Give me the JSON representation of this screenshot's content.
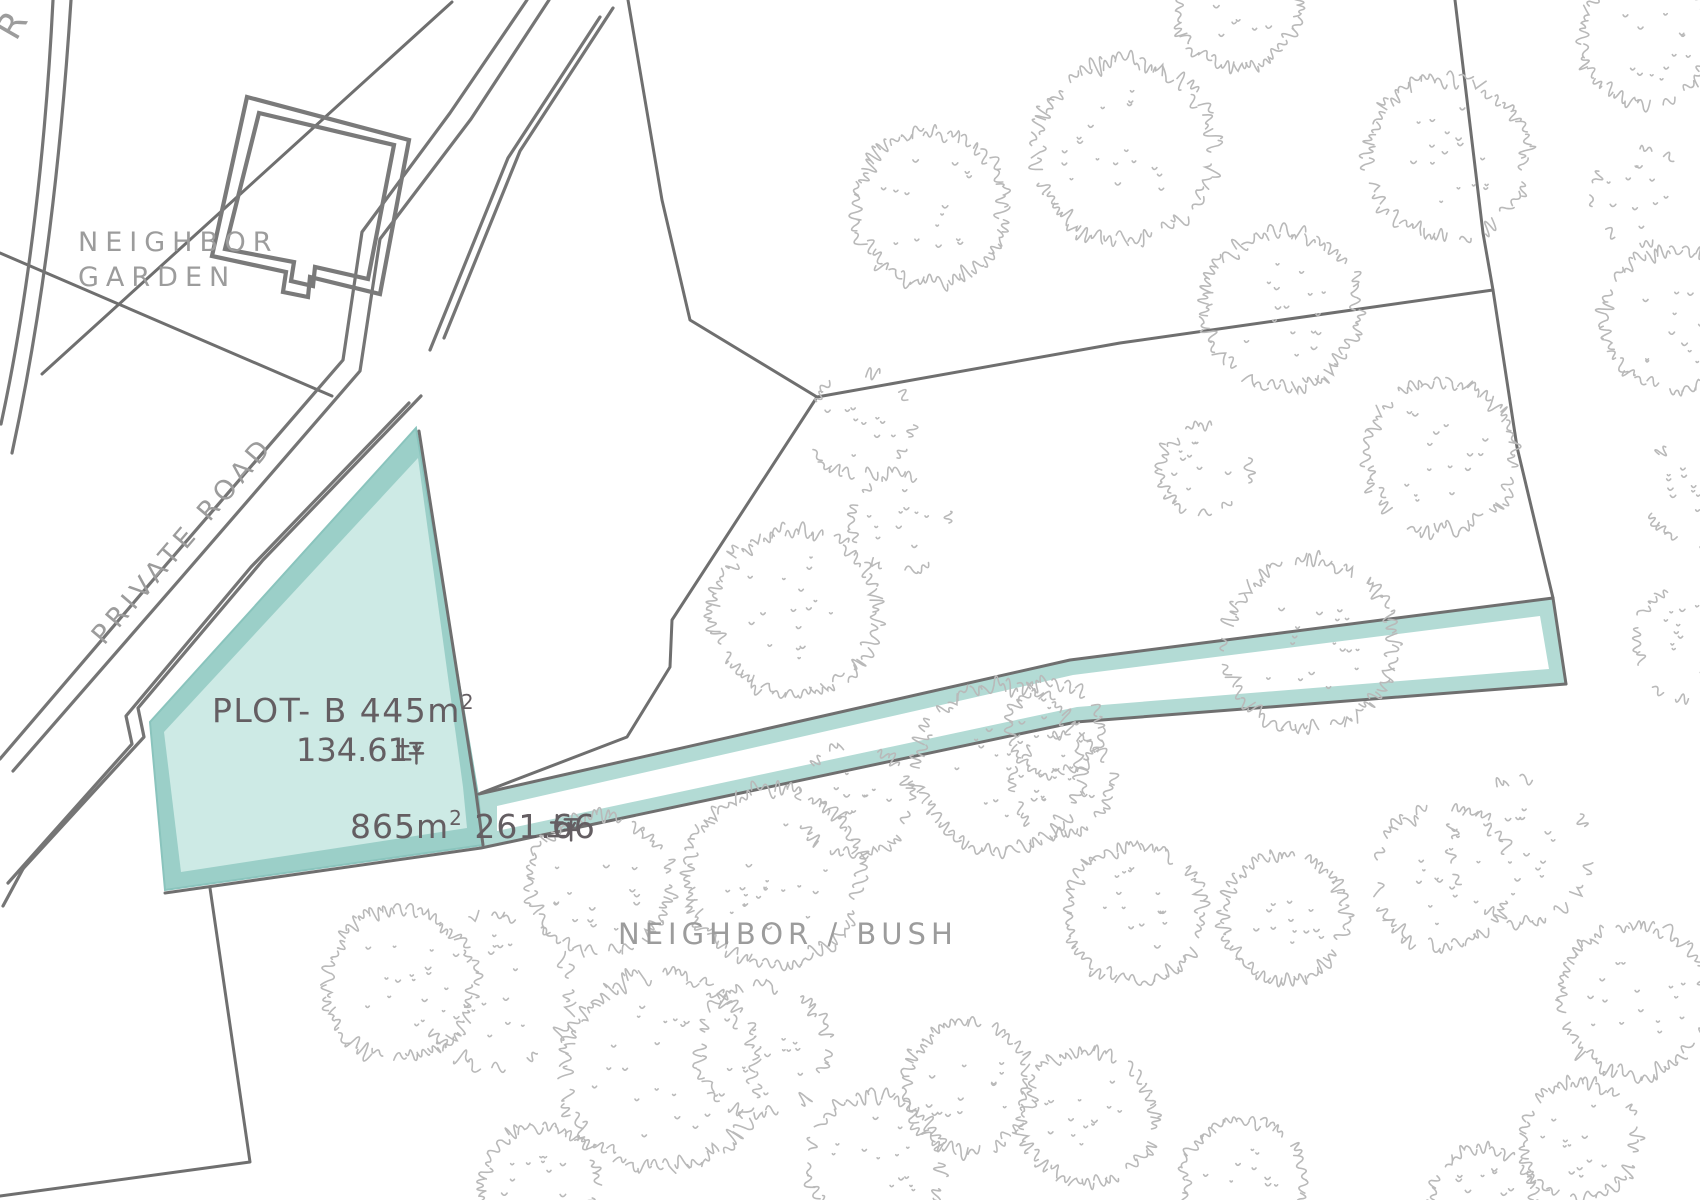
{
  "labels": {
    "corner_road": "R",
    "neighbor_garden_line1": "NEIGHBOR",
    "neighbor_garden_line2": "GARDEN",
    "private_road": "PRIVATE ROAD",
    "neighbor_bush": "NEIGHBOR / BUSH"
  },
  "plots": {
    "plot_b": {
      "name": "PLOT- B",
      "label_main": "PLOT- B  445m",
      "sup": "2",
      "area_m2": "445",
      "tsubo_value": "134.61",
      "tsubo_unit": "坪"
    },
    "strip": {
      "label_main": "865m",
      "sup": "2",
      "area_m2": "865",
      "tsubo_value": " 261.66",
      "tsubo_unit": "坪"
    }
  },
  "colors": {
    "pent_border": "#9bcfc8",
    "pent_fill": "#cdeae5",
    "strip_band": "#b3dbd5",
    "line": "#6f6f6f",
    "road": "#757575",
    "building": "#7a7a7a",
    "text_dark": "#645e62",
    "text_gray": "#9c9c9c",
    "tree": "#b9b9b9"
  }
}
